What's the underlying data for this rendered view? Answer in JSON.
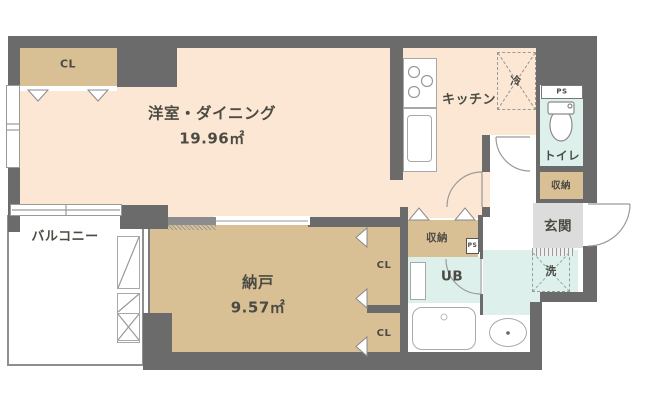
{
  "title": "apartment-floor-plan",
  "palette": {
    "wall": "#6b6b6b",
    "room_floor": "#fbe7d3",
    "closet_floor": "#d9c094",
    "wet_area_floor": "#def0ec",
    "entrance_floor": "#dcdcdc",
    "line": "#9a9a9a",
    "text": "#4b4b44"
  },
  "rooms": {
    "living": {
      "name": "洋室・ダイニング",
      "area": "19.96㎡"
    },
    "storage_room": {
      "name": "納戸",
      "area": "9.57㎡"
    },
    "kitchen": {
      "label": "キッチン"
    },
    "toilet": {
      "label": "トイレ"
    },
    "entrance": {
      "label": "玄関"
    },
    "balcony": {
      "label": "バルコニー"
    },
    "unit_bath": {
      "label": "UB"
    },
    "closet_top": {
      "label": "CL"
    },
    "closet_mid": {
      "label": "CL"
    },
    "closet_low": {
      "label": "CL"
    },
    "storage_hall": {
      "label": "収納"
    },
    "storage_entry": {
      "label": "収納"
    },
    "washer": {
      "label": "洗"
    },
    "fridge": {
      "label": "冷"
    },
    "pipe_space_top": {
      "label": "PS"
    },
    "pipe_space_small": {
      "label": "PS"
    }
  }
}
